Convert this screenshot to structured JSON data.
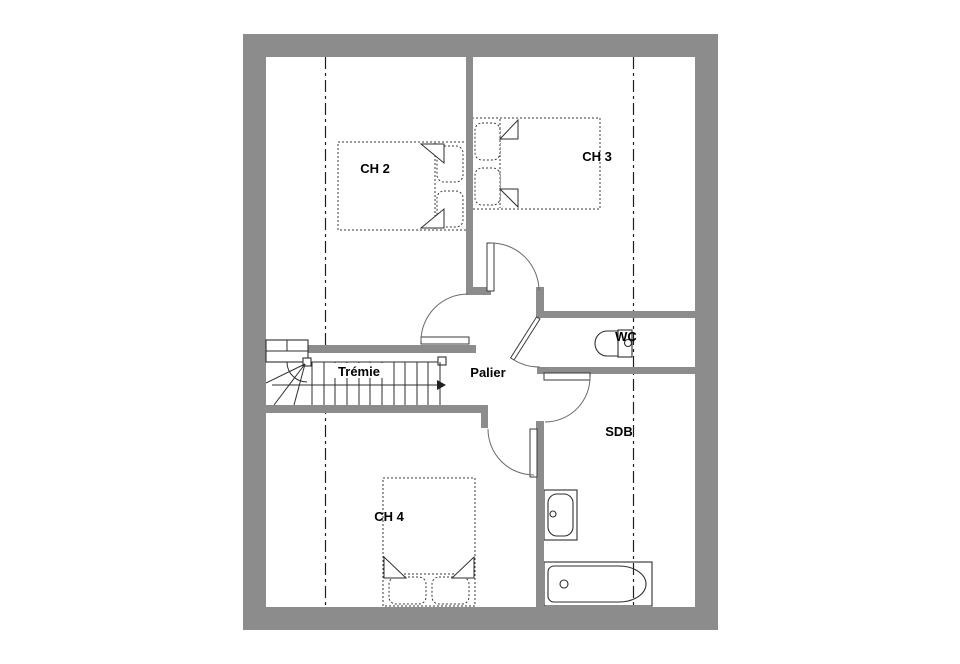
{
  "labels": {
    "ch2": "CH 2",
    "ch3": "CH 3",
    "ch4": "CH 4",
    "tremie": "Trémie",
    "palier": "Palier",
    "wc": "WC",
    "sdb": "SDB"
  },
  "fixtures": {
    "icons": [
      "staircase-icon",
      "direction-arrow-icon",
      "double-bed-icon",
      "toilet-icon",
      "washbasin-icon",
      "bathtub-icon",
      "door-swing-icon"
    ]
  },
  "colors": {
    "wall_gray": "#8c8c8c",
    "line_black": "#1f1f1f",
    "background": "#ffffff"
  }
}
